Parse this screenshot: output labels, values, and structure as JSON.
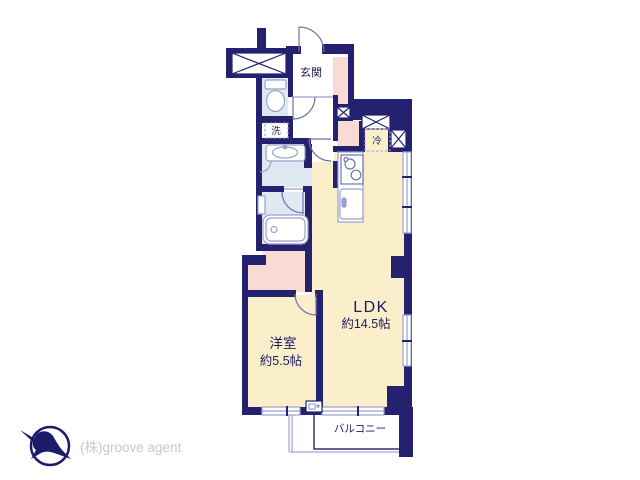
{
  "floorplan": {
    "rooms": {
      "entrance": {
        "label": "玄関"
      },
      "washer": {
        "label": "洗"
      },
      "fridge": {
        "label": "冷"
      },
      "ldk": {
        "name": "LDK",
        "size": "約14.5帖"
      },
      "western_room": {
        "name": "洋室",
        "size": "約5.5帖"
      },
      "balcony": {
        "label": "バルコニー"
      }
    },
    "colors": {
      "wall": "#24226f",
      "room_floor": "#faeecb",
      "corridor": "#f9dbd6",
      "wet_area": "#dfe9f2",
      "fixture_outline": "#99a1cf",
      "label_text": "#1d1c60",
      "logo": "#1b1b6b",
      "company_text": "#c9c9c9"
    }
  },
  "footer": {
    "company": "(株)groove agent"
  }
}
